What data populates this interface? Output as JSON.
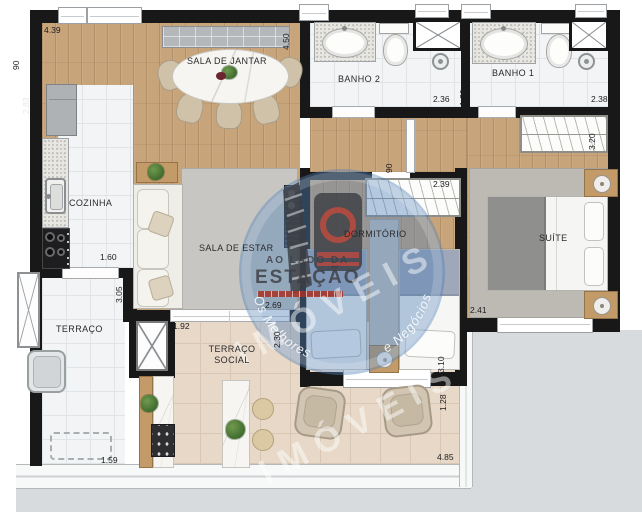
{
  "rooms": {
    "dining": "SALA DE JANTAR",
    "bath2": "BANHO 2",
    "bath1": "BANHO 1",
    "kitchen": "COZINHA",
    "living": "SALA DE ESTAR",
    "bedroom": "DORMITÓRIO",
    "suite": "SUÍTE",
    "terrace": "TERRAÇO",
    "social_terrace": "TERRAÇO SOCIAL"
  },
  "dims": {
    "dining_top": "4.39",
    "wall_left_top": "90",
    "kitchen_left": "2.83",
    "dining_right": "4.50",
    "bath2_left": "1.30",
    "bath2_width": "2.36",
    "bath1_left": "1.30",
    "bath1_width": "2.38",
    "suite_wardrobe": "3.20",
    "bedroom_wardrobe": "2.39",
    "hall_width": "90",
    "kitchen_width": "1.60",
    "terrace_height": "3.05",
    "living_width": "2.69",
    "social_door_a": "1.92",
    "social_door_b": "2.30",
    "bedroom_height": "3.10",
    "suite_width": "2.41",
    "terrace_width": "1.59",
    "social_right": "1.28",
    "social_width": "4.85"
  },
  "watermark": {
    "line_top": "AO LADO DA",
    "line_main": "ESTAÇÃO",
    "line_big": "IMÓVEIS",
    "arc_left": "Os Melhores",
    "arc_right": "e Negócios"
  },
  "colors": {
    "wall": "#181818",
    "wood_floor": "#c8a47a",
    "white_tile": "#f3f4f5",
    "beige_tile": "#e7d8c8",
    "exterior": "#d8dbdd",
    "watermark_blue": "#5280b8",
    "watermark_red": "#a83024"
  }
}
